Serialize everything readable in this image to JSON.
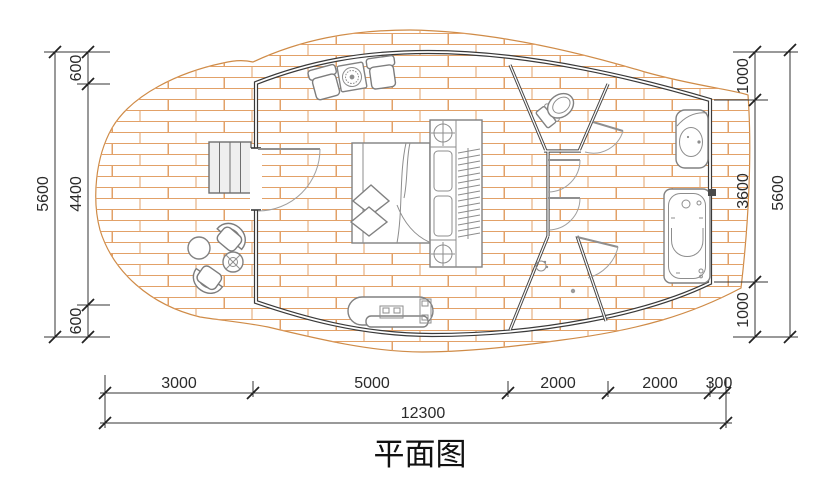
{
  "title": "平面图",
  "dimensions": {
    "left_outer": "5600",
    "left_top": "600",
    "left_mid": "4400",
    "left_bottom": "600",
    "right_top": "1000",
    "right_mid": "3600",
    "right_bottom": "1000",
    "right_outer": "5600",
    "bottom_1": "3000",
    "bottom_2": "5000",
    "bottom_3": "2000",
    "bottom_4": "2000",
    "bottom_5": "300",
    "bottom_total": "12300"
  },
  "colors": {
    "deck_outline": "#cf8b47",
    "plank_line": "#e2a168",
    "wall": "#3a3a3a",
    "partition": "#474747",
    "fixture": "#818181",
    "dimension": "#2b2b2b",
    "paper": "#ffffff"
  },
  "fixtures": [
    "stairs-icon",
    "entry-door-icon",
    "bed-icon",
    "pillow-icon",
    "wardrobe-icon",
    "ceiling-lamp-icon",
    "armchair-icon",
    "stove-table-icon",
    "toilet-icon",
    "shower-head-icon",
    "floor-drain-icon",
    "washbasin-icon",
    "bathtub-icon",
    "kitchen-counter-icon",
    "outdoor-chair-icon",
    "outdoor-table-icon",
    "potted-plant-icon"
  ]
}
